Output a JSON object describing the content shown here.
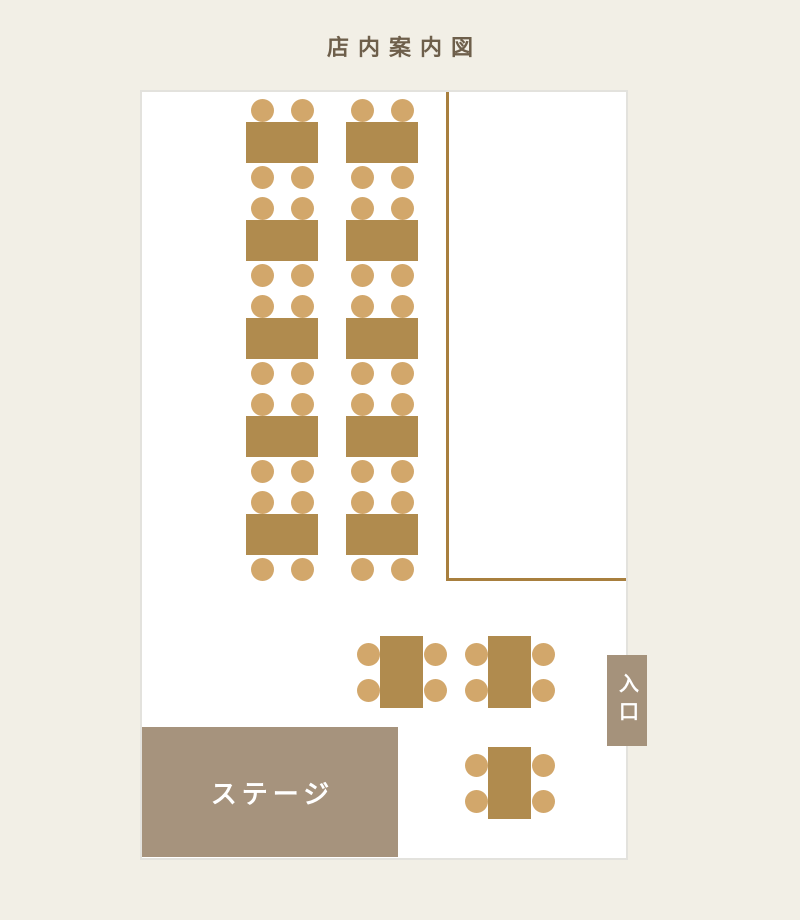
{
  "title": "店内案内図",
  "colors": {
    "background": "#f2efe6",
    "floor": "#ffffff",
    "floor_border": "#e3e2dd",
    "table": "#b08b4e",
    "chair": "#d2a76b",
    "wall_line": "#a87f3e",
    "stage": "#a6937d",
    "entrance": "#a5927b",
    "title_text": "#6e5f4b",
    "label_text": "#ffffff"
  },
  "stage": {
    "label": "ステージ"
  },
  "entrance": {
    "label": "入口"
  },
  "floor_plan": {
    "description": "restaurant seating map with 13 four-seat tables, a stage and an entrance",
    "seats_per_table": 4,
    "tables": [
      {
        "id": 1,
        "x": 246,
        "y": 122,
        "w": 72,
        "h": 41,
        "orientation": "horizontal"
      },
      {
        "id": 2,
        "x": 246,
        "y": 220,
        "w": 72,
        "h": 41,
        "orientation": "horizontal"
      },
      {
        "id": 3,
        "x": 246,
        "y": 318,
        "w": 72,
        "h": 41,
        "orientation": "horizontal"
      },
      {
        "id": 4,
        "x": 246,
        "y": 416,
        "w": 72,
        "h": 41,
        "orientation": "horizontal"
      },
      {
        "id": 5,
        "x": 246,
        "y": 514,
        "w": 72,
        "h": 41,
        "orientation": "horizontal"
      },
      {
        "id": 6,
        "x": 346,
        "y": 122,
        "w": 72,
        "h": 41,
        "orientation": "horizontal"
      },
      {
        "id": 7,
        "x": 346,
        "y": 220,
        "w": 72,
        "h": 41,
        "orientation": "horizontal"
      },
      {
        "id": 8,
        "x": 346,
        "y": 318,
        "w": 72,
        "h": 41,
        "orientation": "horizontal"
      },
      {
        "id": 9,
        "x": 346,
        "y": 416,
        "w": 72,
        "h": 41,
        "orientation": "horizontal"
      },
      {
        "id": 10,
        "x": 346,
        "y": 514,
        "w": 72,
        "h": 41,
        "orientation": "horizontal"
      },
      {
        "id": 11,
        "x": 380,
        "y": 636,
        "w": 43,
        "h": 72,
        "orientation": "vertical"
      },
      {
        "id": 12,
        "x": 488,
        "y": 636,
        "w": 43,
        "h": 72,
        "orientation": "vertical"
      },
      {
        "id": 13,
        "x": 488,
        "y": 747,
        "w": 43,
        "h": 72,
        "orientation": "vertical"
      }
    ],
    "walls": [
      {
        "id": "wall-vertical",
        "type": "vertical",
        "x": 446,
        "y": 92,
        "length": 489,
        "thickness": 3
      },
      {
        "id": "wall-horizontal",
        "type": "horizontal",
        "x": 446,
        "y": 578,
        "length": 180,
        "thickness": 3
      }
    ]
  }
}
